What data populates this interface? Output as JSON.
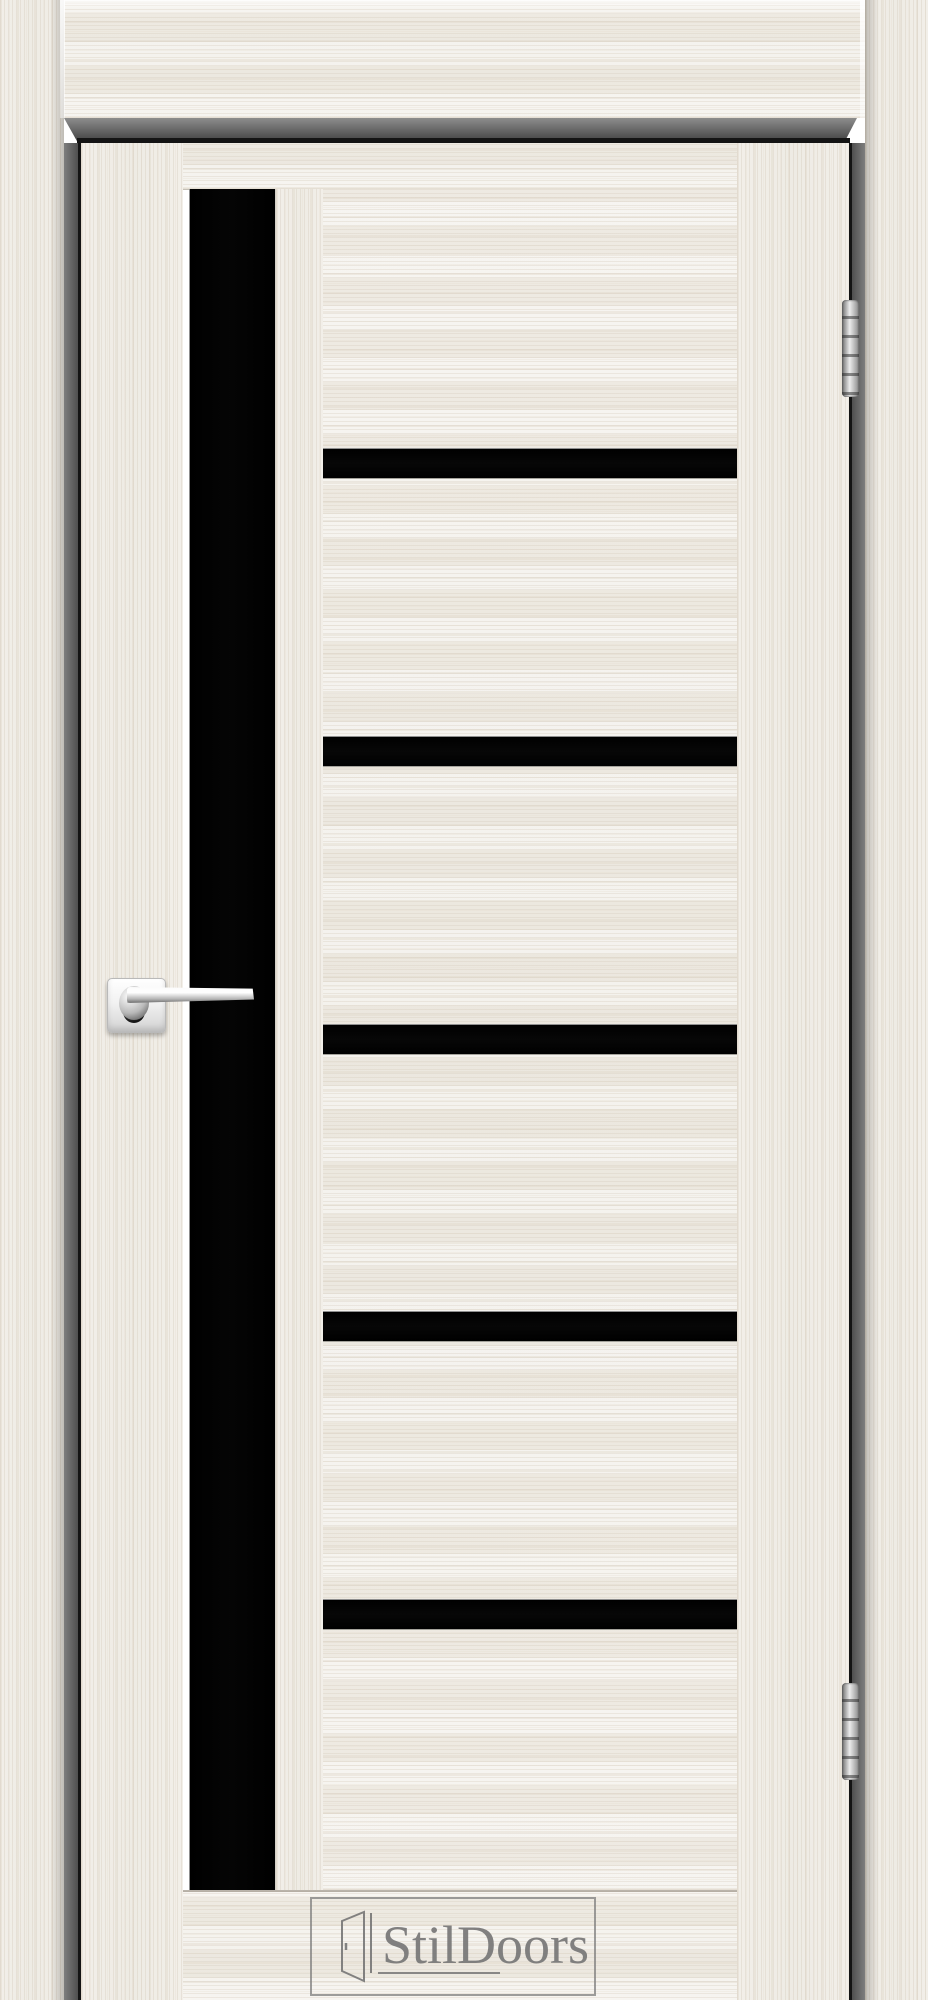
{
  "brand": {
    "logo_text": "StilDoors"
  },
  "logo": {
    "icon": "open-door-icon",
    "text_color": "#767676",
    "border_color": "#7d7d7d"
  },
  "door": {
    "vertical_glass_strips": 1,
    "horizontal_glass_strips": 5,
    "hinge_count": 2,
    "handle_type": "chrome-lever",
    "handle_side": "left",
    "hinge_side": "right"
  },
  "colors": {
    "wood_base": "#f0ede7",
    "wood_grain": "#d5cbbc",
    "frame_reveal": "#5f5f5f",
    "gap_shadow": "#141414",
    "glass": "#050505",
    "chrome": "#ececec"
  }
}
